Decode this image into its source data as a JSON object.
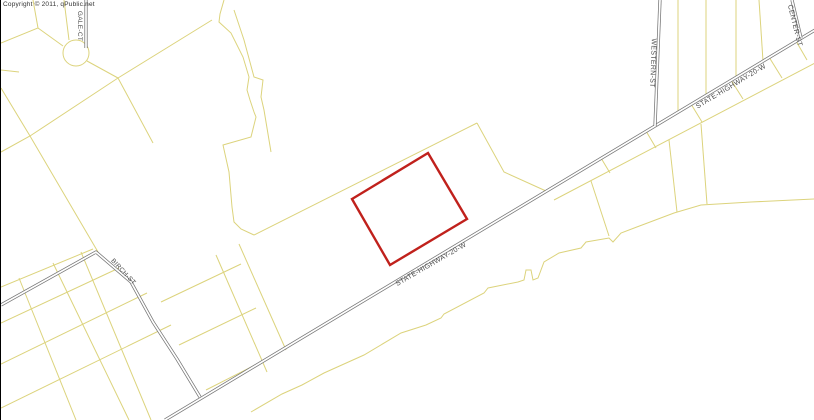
{
  "map": {
    "copyright": "Copyright © 2011, qPublic.net",
    "colors": {
      "background": "#ffffff",
      "parcel_line": "#dcd37c",
      "road_casing": "#757575",
      "road_center": "#ffffff",
      "highlight": "#c0211c",
      "street_label": "#4d4d4d",
      "copyright_text": "#333333",
      "border_left": "#000000"
    },
    "highlight_parcel": {
      "name": "selected-parcel",
      "points": [
        [
          427,
          153
        ],
        [
          466,
          219
        ],
        [
          389,
          265
        ],
        [
          351,
          199
        ]
      ]
    },
    "circles": [
      {
        "name": "gale-ct-cul-de-sac",
        "cx": 75,
        "cy": 53,
        "r": 13
      }
    ],
    "roads": [
      {
        "name": "state-highway-20-w",
        "points": [
          [
            814,
            30
          ],
          [
            164,
            420
          ]
        ]
      },
      {
        "name": "birch-st",
        "points": [
          [
            0,
            305
          ],
          [
            95,
            252
          ],
          [
            130,
            282
          ],
          [
            152,
            322
          ],
          [
            176,
            359
          ],
          [
            199,
            397
          ]
        ]
      },
      {
        "name": "gale-ct",
        "points": [
          [
            85,
            0
          ],
          [
            85,
            48
          ]
        ]
      },
      {
        "name": "western-st",
        "points": [
          [
            659,
            0
          ],
          [
            654,
            126
          ]
        ]
      },
      {
        "name": "center-st",
        "points": [
          [
            791,
            0
          ],
          [
            800,
            38
          ]
        ]
      }
    ],
    "parcel_lines": [
      {
        "points": [
          [
            0,
            43
          ],
          [
            37,
            28
          ],
          [
            32,
            0
          ]
        ]
      },
      {
        "points": [
          [
            37,
            28
          ],
          [
            62,
            46
          ]
        ]
      },
      {
        "points": [
          [
            63,
            0
          ],
          [
            68,
            40
          ]
        ]
      },
      {
        "points": [
          [
            86,
            61
          ],
          [
            117,
            78
          ]
        ]
      },
      {
        "points": [
          [
            0,
            152
          ],
          [
            29,
            136
          ],
          [
            117,
            78
          ],
          [
            211,
            20
          ]
        ]
      },
      {
        "points": [
          [
            0,
            88
          ],
          [
            29,
            136
          ],
          [
            97,
            252
          ]
        ]
      },
      {
        "points": [
          [
            0,
            70
          ],
          [
            18,
            72
          ]
        ]
      },
      {
        "points": [
          [
            117,
            78
          ],
          [
            152,
            143
          ]
        ]
      },
      {
        "points": [
          [
            223,
            0
          ],
          [
            219,
            14
          ],
          [
            218,
            22
          ],
          [
            230,
            33
          ],
          [
            242,
            57
          ],
          [
            248,
            77
          ],
          [
            246,
            90
          ],
          [
            249,
            100
          ],
          [
            253,
            112
          ],
          [
            255,
            117
          ],
          [
            250,
            137
          ],
          [
            222,
            145
          ],
          [
            228,
            172
          ],
          [
            231,
            207
          ],
          [
            233,
            222
          ],
          [
            240,
            229
          ],
          [
            253,
            235
          ]
        ]
      },
      {
        "points": [
          [
            233,
            10
          ],
          [
            243,
            40
          ],
          [
            253,
            77
          ],
          [
            262,
            80
          ],
          [
            260,
            97
          ],
          [
            263,
            110
          ],
          [
            268,
            140
          ],
          [
            270,
            152
          ]
        ]
      },
      {
        "points": [
          [
            253,
            235
          ],
          [
            476,
            123
          ]
        ]
      },
      {
        "points": [
          [
            476,
            123
          ],
          [
            503,
            172
          ],
          [
            545,
            191
          ]
        ]
      },
      {
        "points": [
          [
            553,
            200
          ],
          [
            814,
            63
          ]
        ]
      },
      {
        "points": [
          [
            600,
            158
          ],
          [
            609,
            173
          ]
        ]
      },
      {
        "points": [
          [
            645,
            131
          ],
          [
            655,
            148
          ]
        ]
      },
      {
        "points": [
          [
            690,
            104
          ],
          [
            701,
            122
          ]
        ]
      },
      {
        "points": [
          [
            730,
            80
          ],
          [
            742,
            99
          ]
        ]
      },
      {
        "points": [
          [
            768,
            57
          ],
          [
            781,
            78
          ]
        ]
      },
      {
        "points": [
          [
            795,
            41
          ],
          [
            806,
            60
          ]
        ]
      },
      {
        "points": [
          [
            250,
            412
          ],
          [
            281,
            394
          ],
          [
            301,
            385
          ],
          [
            323,
            373
          ],
          [
            363,
            355
          ],
          [
            400,
            333
          ],
          [
            425,
            325
          ],
          [
            440,
            318
          ],
          [
            443,
            314
          ],
          [
            483,
            293
          ],
          [
            487,
            288
          ],
          [
            517,
            282
          ],
          [
            523,
            280
          ],
          [
            525,
            270
          ],
          [
            530,
            270
          ],
          [
            532,
            280
          ],
          [
            537,
            278
          ],
          [
            543,
            262
          ],
          [
            558,
            253
          ],
          [
            580,
            248
          ],
          [
            585,
            242
          ],
          [
            608,
            238
          ],
          [
            612,
            242
          ],
          [
            620,
            233
          ],
          [
            673,
            213
          ],
          [
            700,
            205
          ],
          [
            750,
            202
          ],
          [
            814,
            199
          ]
        ]
      },
      {
        "points": [
          [
            590,
            181
          ],
          [
            608,
            236
          ]
        ]
      },
      {
        "points": [
          [
            668,
            140
          ],
          [
            676,
            212
          ]
        ]
      },
      {
        "points": [
          [
            700,
            124
          ],
          [
            706,
            204
          ]
        ]
      },
      {
        "points": [
          [
            677,
            0
          ],
          [
            677,
            112
          ]
        ]
      },
      {
        "points": [
          [
            705,
            0
          ],
          [
            705,
            95
          ]
        ]
      },
      {
        "points": [
          [
            735,
            0
          ],
          [
            735,
            77
          ]
        ]
      },
      {
        "points": [
          [
            758,
            0
          ],
          [
            762,
            61
          ]
        ]
      },
      {
        "points": [
          [
            0,
            287
          ],
          [
            92,
            249
          ]
        ]
      },
      {
        "points": [
          [
            0,
            323
          ],
          [
            118,
            268
          ]
        ]
      },
      {
        "points": [
          [
            0,
            364
          ],
          [
            146,
            293
          ]
        ]
      },
      {
        "points": [
          [
            0,
            408
          ],
          [
            170,
            325
          ]
        ]
      },
      {
        "points": [
          [
            18,
            278
          ],
          [
            75,
            420
          ]
        ]
      },
      {
        "points": [
          [
            52,
            263
          ],
          [
            128,
            420
          ]
        ]
      },
      {
        "points": [
          [
            80,
            252
          ],
          [
            150,
            420
          ]
        ]
      },
      {
        "points": [
          [
            160,
            302
          ],
          [
            240,
            264
          ]
        ]
      },
      {
        "points": [
          [
            178,
            345
          ],
          [
            255,
            308
          ]
        ]
      },
      {
        "points": [
          [
            205,
            390
          ],
          [
            260,
            362
          ]
        ]
      },
      {
        "points": [
          [
            215,
            255
          ],
          [
            266,
            372
          ]
        ]
      },
      {
        "points": [
          [
            238,
            244
          ],
          [
            285,
            350
          ]
        ]
      }
    ],
    "labels": [
      {
        "name": "label-gale-ct",
        "text": "GALE-CT",
        "x": 77,
        "y": 26,
        "rotate": 90,
        "small": true
      },
      {
        "name": "label-western-st",
        "text": "WESTERN-ST",
        "x": 650,
        "y": 63,
        "rotate": 92,
        "small": false
      },
      {
        "name": "label-center-st",
        "text": "CENTER-ST",
        "x": 792,
        "y": 26,
        "rotate": 76,
        "small": false
      },
      {
        "name": "label-state-highway-20-w-upper",
        "text": "STATE-HIGHWAY-20-W",
        "x": 731,
        "y": 88,
        "rotate": -31,
        "small": false
      },
      {
        "name": "label-state-highway-20-w-lower",
        "text": "STATE-HIGHWAY-20-W",
        "x": 431,
        "y": 266,
        "rotate": -30,
        "small": false
      },
      {
        "name": "label-birch-st",
        "text": "BIRCH-ST",
        "x": 121,
        "y": 273,
        "rotate": 47,
        "small": true
      }
    ]
  }
}
